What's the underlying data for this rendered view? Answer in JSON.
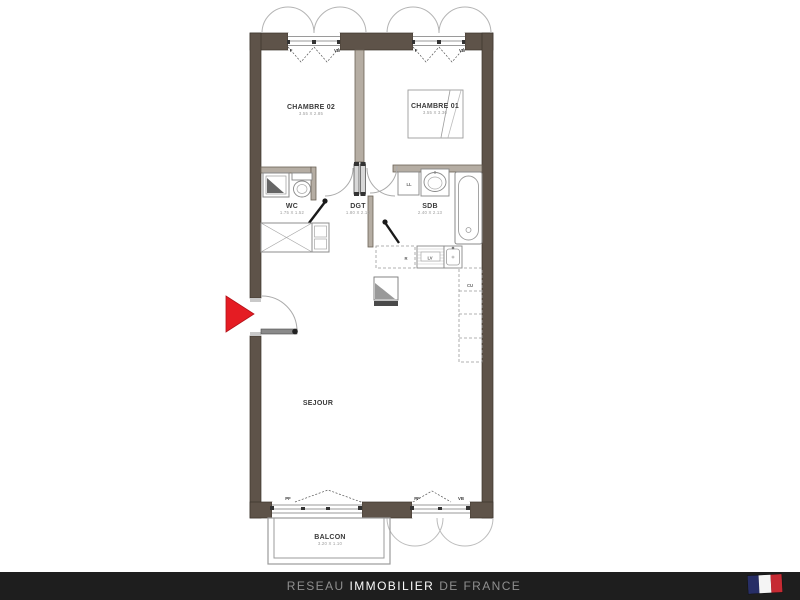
{
  "page": {
    "background": "#ffffff"
  },
  "plan": {
    "wall_color": "#5e5349",
    "arrow_color": "#e51c23",
    "rooms": {
      "chambre02": {
        "label": "CHAMBRE 02",
        "dims": "3.55 X 2.85"
      },
      "chambre01": {
        "label": "CHAMBRE 01",
        "dims": "3.55 X 3.30"
      },
      "wc": {
        "label": "WC",
        "dims": "1.75 X 1.52"
      },
      "dgt": {
        "label": "DGT",
        "dims": "1.80 X 2.13"
      },
      "sdb": {
        "label": "SDB",
        "dims": "2.40 X 2.13"
      },
      "sejour": {
        "label": "SEJOUR"
      },
      "balcon": {
        "label": "BALCON",
        "dims": "3.20 X 1.10"
      }
    },
    "opening_labels": {
      "window": "F",
      "upper_vent": "VB",
      "french_door": "PF"
    },
    "fixture_labels": {
      "washing_machine": "LL",
      "fridge": "R",
      "dishwasher": "LV",
      "kitchen_column": "CU"
    }
  },
  "footer": {
    "bar_color": "#1e1e1e",
    "brand_prefix": "RESEAU",
    "brand_main": "IMMOBILIER",
    "brand_suffix": "DE FRANCE",
    "flag_colors": {
      "blue": "#272e66",
      "white": "#f4f4f4",
      "red": "#c62a33"
    }
  }
}
